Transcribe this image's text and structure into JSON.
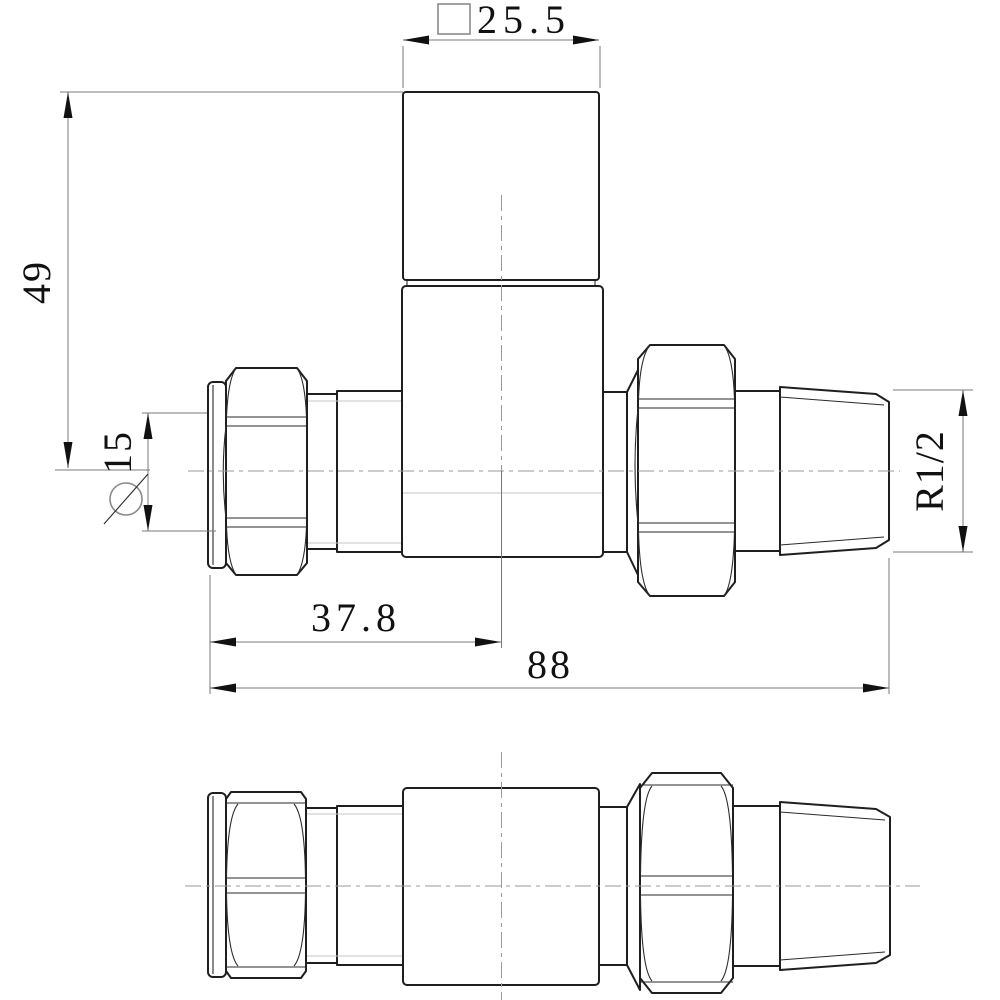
{
  "drawing": {
    "type": "engineering-orthographic-views",
    "subject": "straight radiator valve, front view (top) and side view (bottom)",
    "background_color": "#ffffff",
    "object_line_color": "#1f1f1f",
    "dimension_line_color": "#787878",
    "centerline_color": "#9a9a9a",
    "dims": {
      "head_square": {
        "symbol": "square",
        "value": "25.5"
      },
      "height_to_center": {
        "value": "49"
      },
      "pipe_diameter": {
        "symbol": "diameter",
        "value": "15"
      },
      "center_from_left": {
        "value": "37.8"
      },
      "overall_length": {
        "value": "88"
      },
      "thread_size": {
        "value": "R1/2"
      }
    }
  }
}
